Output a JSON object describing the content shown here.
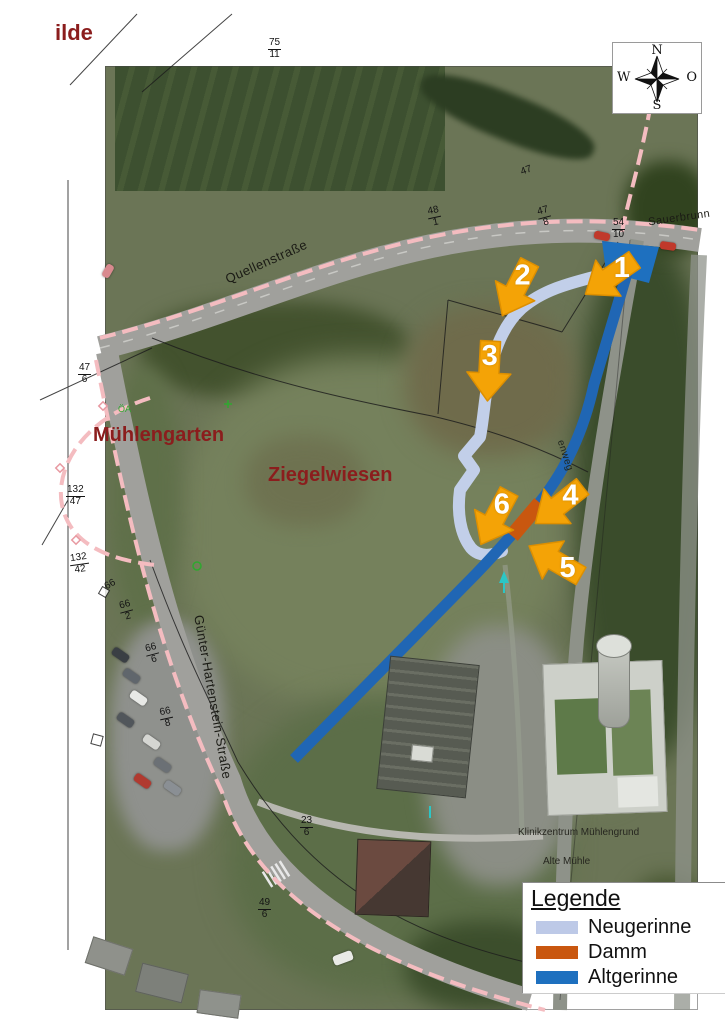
{
  "compass": {
    "north": "N",
    "east": "O",
    "south": "S",
    "west": "W"
  },
  "legend": {
    "title": "Legende",
    "items": [
      {
        "label": "Neugerinne",
        "color": "#bdc9e7"
      },
      {
        "label": "Damm",
        "color": "#c9570f"
      },
      {
        "label": "Altgerinne",
        "color": "#1e70bf"
      }
    ]
  },
  "annotations": {
    "arrow_labels": [
      "1",
      "2",
      "3",
      "4",
      "5",
      "6"
    ],
    "arrow_color": "#f4a306"
  },
  "map": {
    "margin_label_fragment": "ilde",
    "area_labels": {
      "muehlengarten": "Mühlengarten",
      "ziegelwiesen": "Ziegelwiesen"
    },
    "street_labels": {
      "quellenstrasse": "Quellenstraße",
      "guenter_hartenstein": "Günter-Hartenstein-Straße",
      "sauerbrunnen_fragment": "Sauerbrunn",
      "weg_fragment": "enweg"
    },
    "poi_labels": {
      "klinikzentrum": "Klinikzentrum Mühlengrund",
      "alte_muehle": "Alte Mühle"
    },
    "survey_mark": "ÖA",
    "parcel_numbers": [
      {
        "top": "75",
        "bottom": "11"
      },
      {
        "top": "47",
        "bottom": "6"
      },
      {
        "top": "132",
        "bottom": "47"
      },
      {
        "top": "132",
        "bottom": "42"
      },
      {
        "top": "66",
        "bottom": "2"
      },
      {
        "top": "66",
        "bottom": "6"
      },
      {
        "top": "66",
        "bottom": "8"
      },
      {
        "top": "23",
        "bottom": "6"
      },
      {
        "top": "49",
        "bottom": "6"
      },
      {
        "top": "54",
        "bottom": "10"
      },
      {
        "top": "48",
        "bottom": "1"
      },
      {
        "top": "47",
        "bottom": "8"
      },
      {
        "top": "47",
        "bottom": ""
      },
      {
        "top": "66",
        "bottom": ""
      }
    ]
  }
}
